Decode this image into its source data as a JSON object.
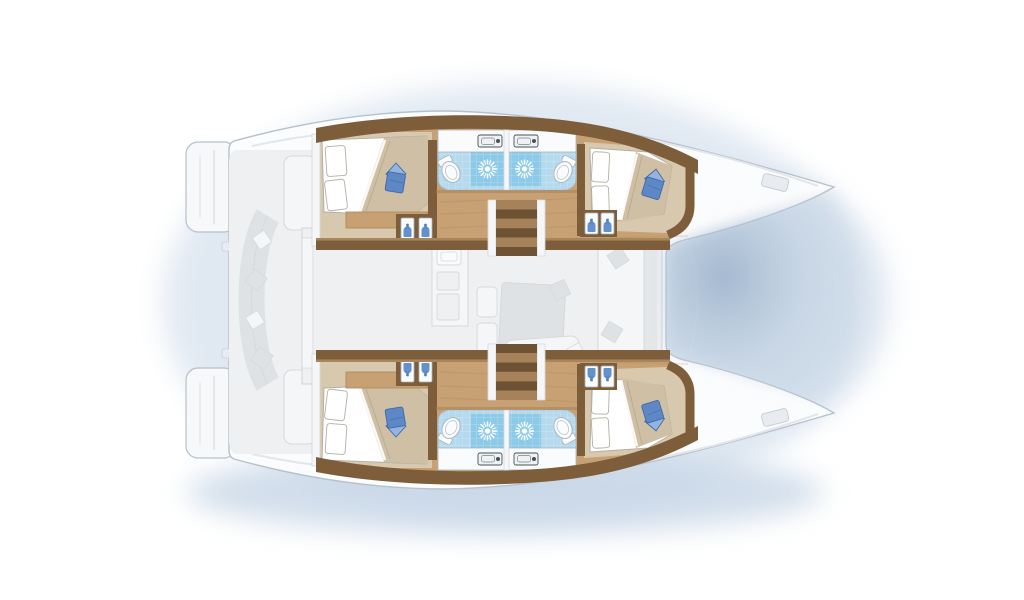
{
  "meta": {
    "type": "catamaran-floor-plan",
    "view": "top-down deck and cabin layout, no text labels visible",
    "canvas": {
      "width": 1024,
      "height": 600
    }
  },
  "plan": {
    "hulls": [
      {
        "id": "port-hull",
        "position": "top",
        "rooms": [
          "aft-double-cabin",
          "bathroom",
          "bathroom",
          "forward-double-cabin"
        ],
        "features": [
          "companionway-stairs",
          "hanging-lockers",
          "wood-corridor",
          "blue-accent-pillows"
        ]
      },
      {
        "id": "starboard-hull",
        "position": "bottom",
        "rooms": [
          "aft-double-cabin",
          "bathroom",
          "bathroom",
          "forward-double-cabin"
        ],
        "features": [
          "companionway-stairs",
          "hanging-lockers",
          "wood-corridor",
          "blue-accent-pillows"
        ]
      }
    ],
    "center_deck": {
      "style": "faded-grey",
      "areas": [
        "aft-cockpit-with-curved-bench",
        "salon",
        "galley-with-stove-and-sinks",
        "dining-table-with-seats",
        "forward-shadow-between-bows"
      ]
    },
    "fixture_counts": {
      "double_beds": 4,
      "showers": 4,
      "toilets": 4,
      "washbasins": 4,
      "stair_flights": 2,
      "hanging_locker_pairs": 4,
      "deck_hatches": 2,
      "transom_platforms": 2
    }
  },
  "colors": {
    "bg": "#ffffff",
    "halo": "#dbe5f0",
    "halo_deep": "#c6d5e6",
    "notch_dark": "#9db3cc",
    "notch_mid": "#c3d2e2",
    "deck": "#fbfcfd",
    "deck_stroke": "#b7c1cb",
    "deck_seam": "#e3e7ec",
    "transom": "#f6f8fa",
    "hatch": "#e8ecf0",
    "hatch_stroke": "#c9cfd6",
    "faded_bg": "#eef0f2",
    "faded_fill": "#f5f6f8",
    "faded_shape": "#dfe2e5",
    "faded_stroke": "#d6d9dc",
    "burner": "#ced3d7",
    "wood": "#c7a173",
    "wood_dark": "#ad8655",
    "wall": "#7e5d3b",
    "wall_light": "#a8865c",
    "beige": "#d8c9ae",
    "duvet": "#cfc0a5",
    "duvet_shade": "#b6a88c",
    "linen": "#ffffff",
    "linen_stroke": "#b4afa3",
    "pillow": "#5d87c5",
    "pillow_dark": "#3f69a8",
    "pillow_light": "#94b4e0",
    "bath": "#b5daee",
    "shower": "#8ccae8",
    "white_fix": "#f9fbfc",
    "fix_stroke": "#a7b6c0",
    "basin_stroke": "#4a5258",
    "hanger": "#4a7cc2",
    "step_a": "#a5825a",
    "step_b": "#6e5234",
    "tile_line": "#ffffff"
  }
}
